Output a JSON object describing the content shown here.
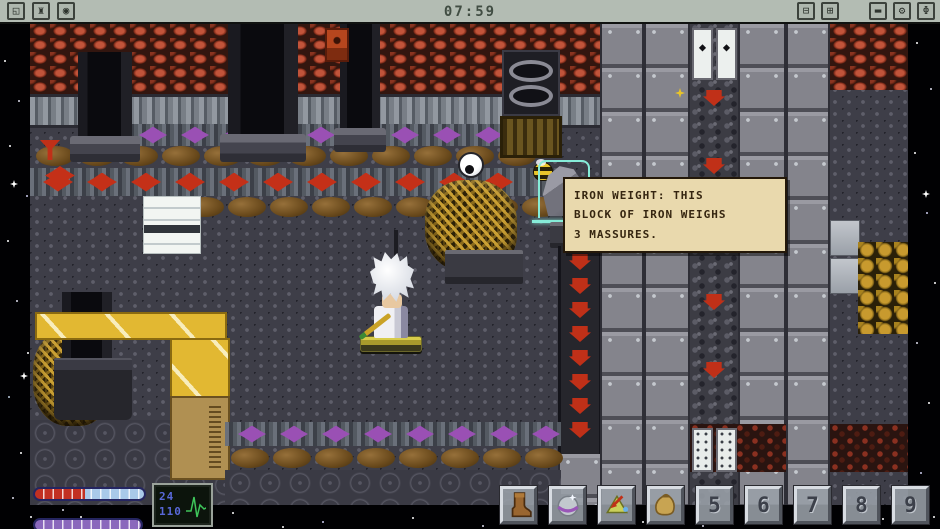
{
  "topbar": {
    "timer": "07:59",
    "left_buttons": [
      {
        "name": "restart",
        "glyph": "◱"
      },
      {
        "name": "factory",
        "glyph": "♜"
      },
      {
        "name": "eye",
        "glyph": "◉"
      }
    ],
    "right_buttons": [
      {
        "name": "zoom-out",
        "glyph": "⊟"
      },
      {
        "name": "zoom-in",
        "glyph": "⊞"
      },
      {
        "name": "minimize",
        "glyph": "▬"
      },
      {
        "name": "settings",
        "glyph": "⚙"
      },
      {
        "name": "power",
        "glyph": "Φ"
      }
    ]
  },
  "tooltip": {
    "full_text": "IRON WEIGHT: THIS BLOCK OF IRON WEIGHS 3 MASSURES.",
    "lines": [
      "IRON WEIGHT: THIS",
      "BLOCK OF IRON WEIGHS",
      "3 MASSURES."
    ]
  },
  "scene": {
    "selected_object": "iron-weight",
    "door_glyph": "◆"
  },
  "hud": {
    "vitals": {
      "top_value": "24",
      "bottom_value": "110"
    },
    "health_bar": {
      "fill_percent": 46,
      "fill_color": "#c23022",
      "empty_color": "#a9c9e9"
    },
    "energy_bar": {
      "fill_percent": 100,
      "fill_color": "#8a68bc"
    }
  },
  "hotbar": {
    "slots": [
      {
        "index": 1,
        "item": "boot"
      },
      {
        "index": 2,
        "item": "bubble-orb"
      },
      {
        "index": 3,
        "item": "beacon"
      },
      {
        "index": 4,
        "item": "sack"
      },
      {
        "index": 5,
        "label": "5"
      },
      {
        "index": 6,
        "label": "6"
      },
      {
        "index": 7,
        "label": "7"
      },
      {
        "index": 8,
        "label": "8"
      },
      {
        "index": 9,
        "label": "9"
      }
    ]
  }
}
